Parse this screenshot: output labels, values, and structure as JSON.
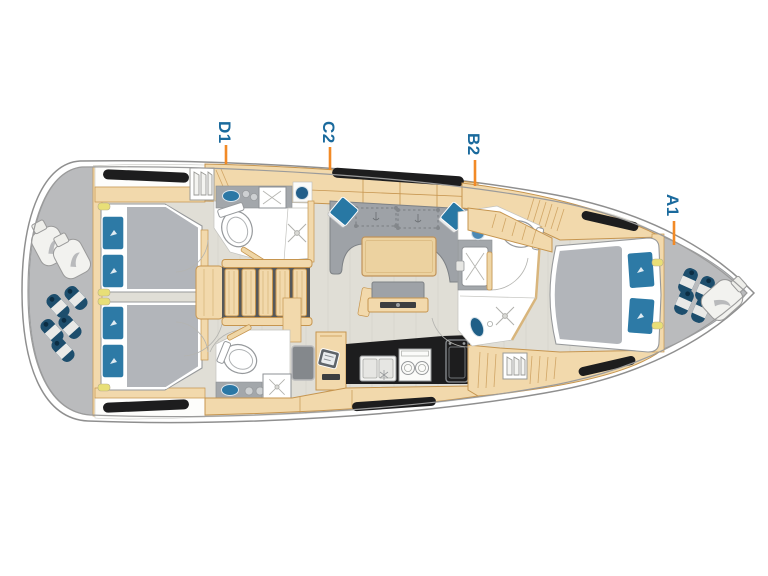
{
  "diagram": {
    "kind": "sailing-yacht-interior-floor-plan",
    "cabin_markers": [
      {
        "id": "D1"
      },
      {
        "id": "C2"
      },
      {
        "id": "B2"
      },
      {
        "id": "A1"
      }
    ]
  },
  "labels": {
    "d1": "D1",
    "c2": "C2",
    "b2": "B2",
    "a1": "A1"
  },
  "colors": {
    "label_text": "#1a6a9d",
    "marker_tick": "#f28a26",
    "deck_gray": "#babbbd",
    "wood": "#f2d9ac",
    "wood_outline": "#c6954f",
    "floor": "#e0ded6",
    "upholstery_gray": "#9ea2a7",
    "cushion_blue": "#2d7aa6",
    "fender_navy": "#1d4e6d",
    "window_black": "#1d1d1e",
    "hull_outline": "#8f8f8f"
  }
}
